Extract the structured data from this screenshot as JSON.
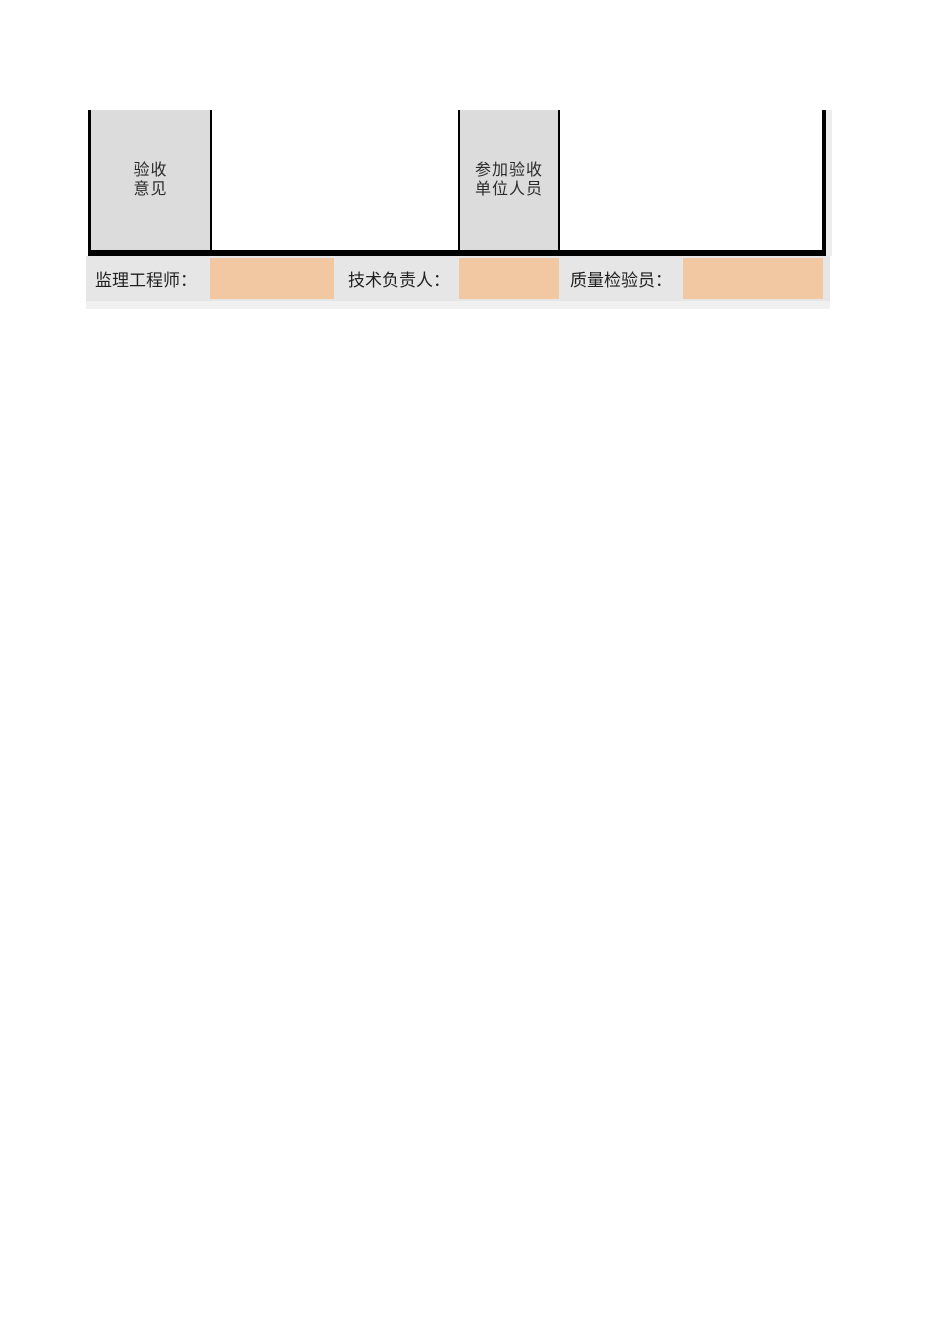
{
  "table": {
    "opinion_label": {
      "line1": "验收",
      "line2": "意见"
    },
    "opinion_content": "",
    "participants_label": {
      "line1": "参加验收",
      "line2": "单位人员"
    },
    "participants_content": ""
  },
  "signature_bar": {
    "supervising_engineer_label": "监理工程师：",
    "technical_director_label": "技术负责人：",
    "quality_inspector_label": "质量检验员：",
    "field_values": {
      "supervising_engineer": "",
      "technical_director": "",
      "quality_inspector": ""
    }
  },
  "colors": {
    "header_cell_gray": "#dcdcdc",
    "signature_bar_gray": "#e6e6e6",
    "signature_field_orange": "#f2c8a2",
    "border_black": "#000000",
    "page_background": "#ffffff"
  }
}
